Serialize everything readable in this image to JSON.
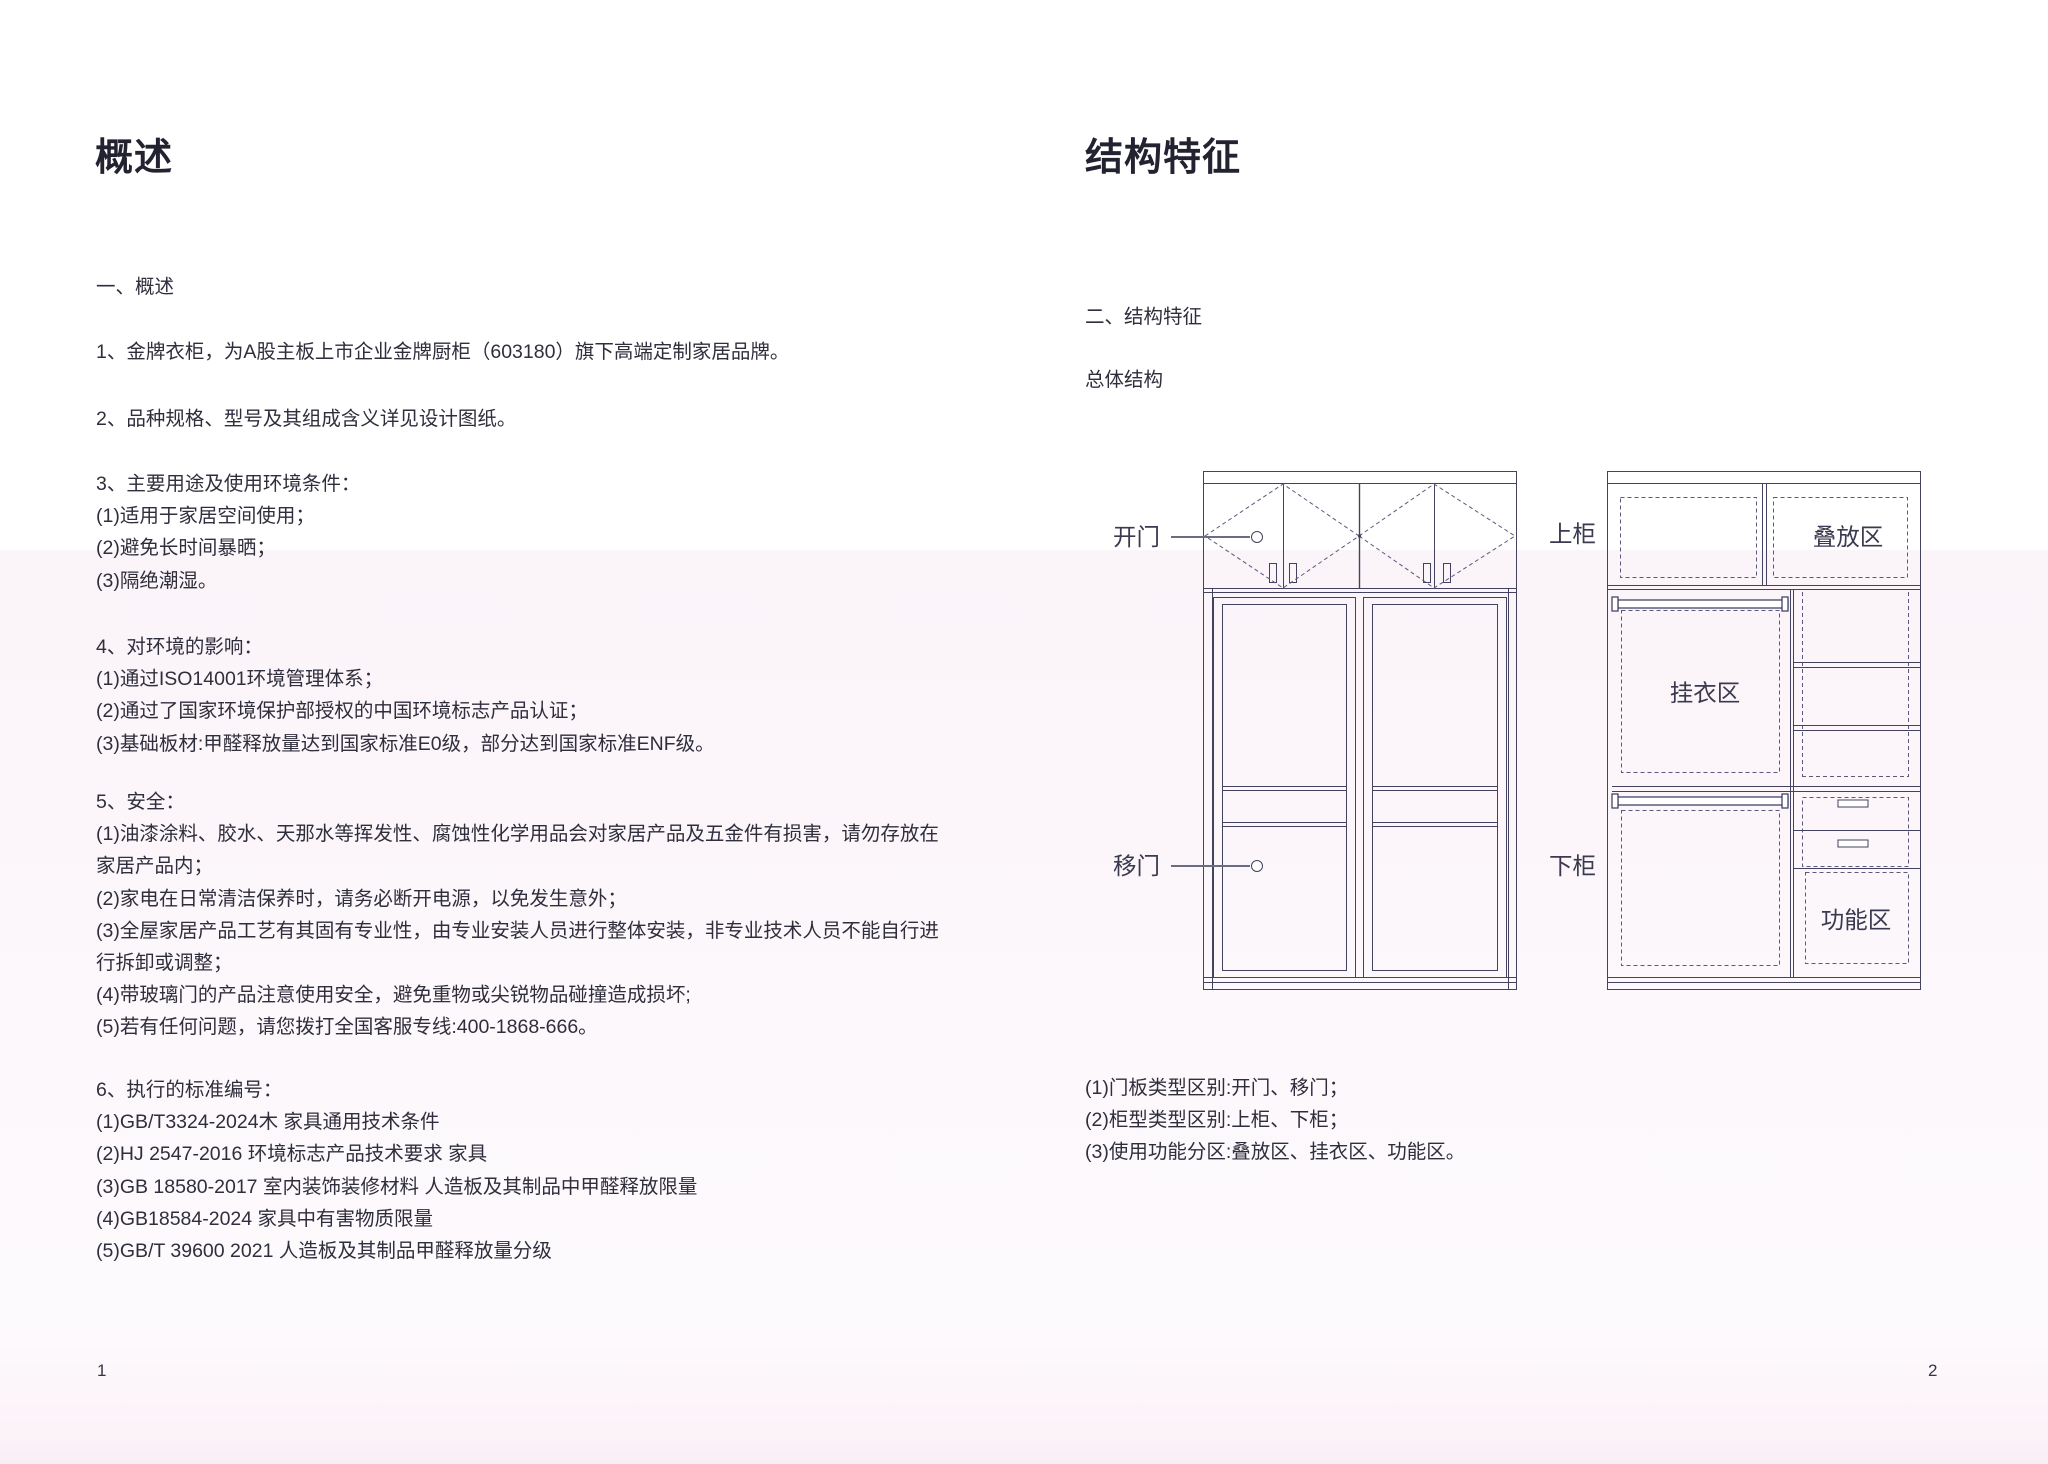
{
  "colors": {
    "diagram_line": "#43435f",
    "diagram_dashed": "#5a5a7d",
    "body_text": "#2f2e3c",
    "band_pink": "#fcf5fa"
  },
  "left_page": {
    "title": "概述",
    "section_heading": "一、概述",
    "blocks": [
      {
        "lines": [
          "1、金牌衣柜，为A股主板上市企业金牌厨柜（603180）旗下高端定制家居品牌。"
        ]
      },
      {
        "lines": [
          "2、品种规格、型号及其组成含义详见设计图纸。"
        ]
      },
      {
        "lines": [
          "3、主要用途及使用环境条件：",
          "(1)适用于家居空间使用；",
          "(2)避免长时间暴晒；",
          "(3)隔绝潮湿。"
        ]
      },
      {
        "lines": [
          "4、对环境的影响：",
          "(1)通过ISO14001环境管理体系；",
          "(2)通过了国家环境保护部授权的中国环境标志产品认证；",
          "(3)基础板材:甲醛释放量达到国家标准E0级，部分达到国家标准ENF级。"
        ]
      },
      {
        "lines": [
          "5、安全：",
          "(1)油漆涂料、胶水、天那水等挥发性、腐蚀性化学用品会对家居产品及五金件有损害，请勿存放在",
          "家居产品内；",
          "(2)家电在日常清洁保养时，请务必断开电源，以免发生意外；",
          "(3)全屋家居产品工艺有其固有专业性，由专业安装人员进行整体安装，非专业技术人员不能自行进",
          "行拆卸或调整；",
          "(4)带玻璃门的产品注意使用安全，避免重物或尖锐物品碰撞造成损坏;",
          "(5)若有任何问题，请您拨打全国客服专线:400-1868-666。"
        ]
      },
      {
        "lines": [
          "6、执行的标准编号：",
          "(1)GB/T3324-2024木 家具通用技术条件",
          "(2)HJ 2547-2016 环境标志产品技术要求 家具",
          "(3)GB 18580-2017 室内装饰装修材料 人造板及其制品中甲醛释放限量",
          "(4)GB18584-2024 家具中有害物质限量",
          "(5)GB/T 39600 2021 人造板及其制品甲醛释放量分级"
        ]
      }
    ],
    "page_number": "1"
  },
  "right_page": {
    "title": "结构特征",
    "section_heading": "二、结构特征",
    "subheading": "总体结构",
    "diagram_labels": {
      "open_door": "开门",
      "sliding_door": "移门",
      "upper_cabinet": "上柜",
      "lower_cabinet": "下柜",
      "stacking_zone": "叠放区",
      "hanging_zone": "挂衣区",
      "function_zone": "功能区"
    },
    "captions": {
      "lines": [
        "(1)门板类型区别:开门、移门；",
        "(2)柜型类型区别:上柜、下柜；",
        "(3)使用功能分区:叠放区、挂衣区、功能区。"
      ]
    },
    "page_number": "2"
  }
}
